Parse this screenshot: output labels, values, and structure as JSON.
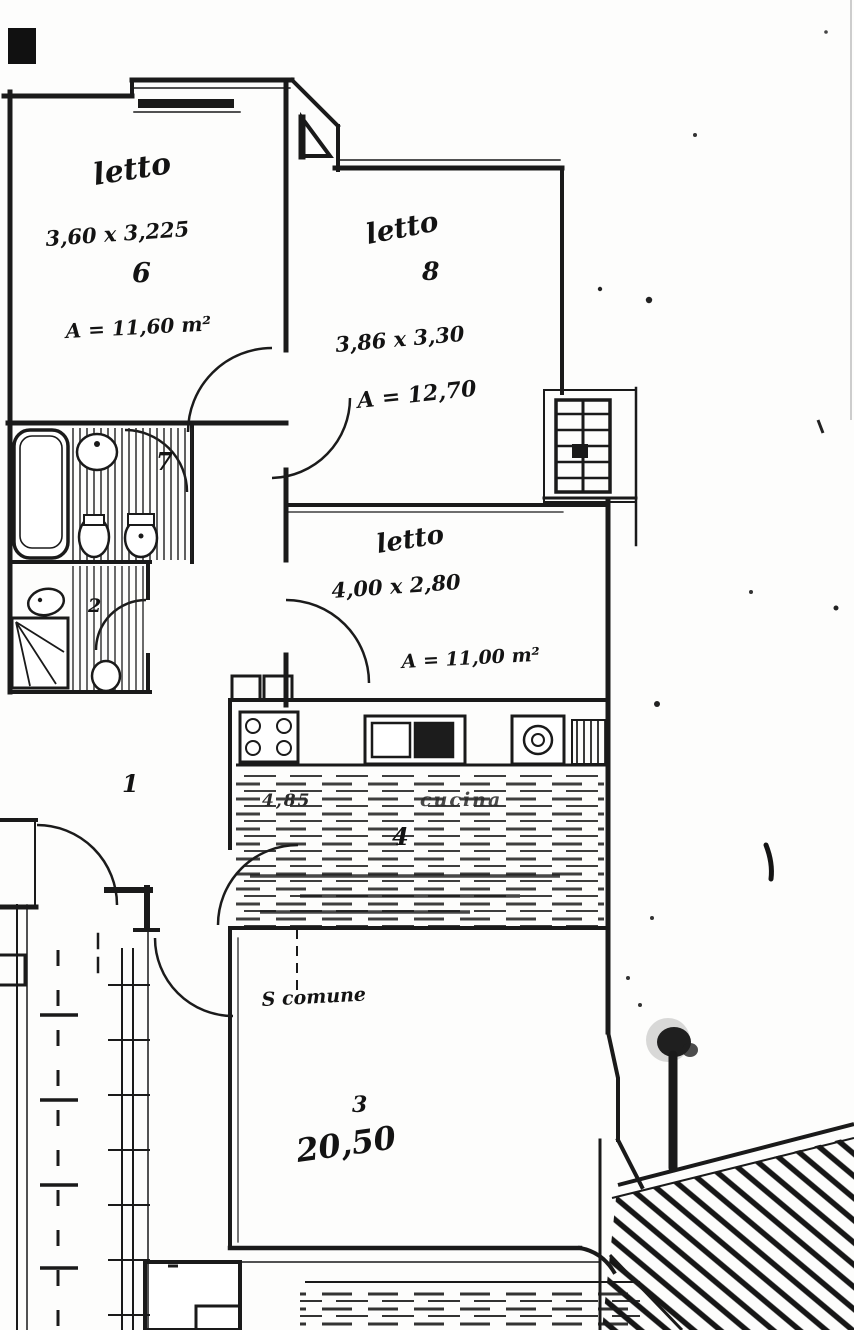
{
  "plan": {
    "title_hint": "scanned apartment floor plan",
    "colors": {
      "ink": "#1a1a1a",
      "paper": "#fdfdfc"
    },
    "rooms": {
      "bedroom6": {
        "name": "letto",
        "dims": "3,60 x 3,225",
        "number": "6",
        "area": "A = 11,60 m²"
      },
      "bedroom8": {
        "name": "letto",
        "number": "8",
        "dims": "3,86 x 3,30",
        "area": "A = 12,70"
      },
      "bedroom5": {
        "name": "letto",
        "dims": "4,00 x 2,80",
        "area": "A = 11,00 m²"
      },
      "kitchen": {
        "name": "cucina",
        "number": "4",
        "dim_left": "4,85"
      },
      "living": {
        "name": "S comune",
        "number": "3",
        "area": "20,50"
      },
      "bath_main": {
        "number": "7"
      },
      "bath_second": {
        "number": "2"
      },
      "hallway": {
        "number": "1"
      }
    }
  }
}
